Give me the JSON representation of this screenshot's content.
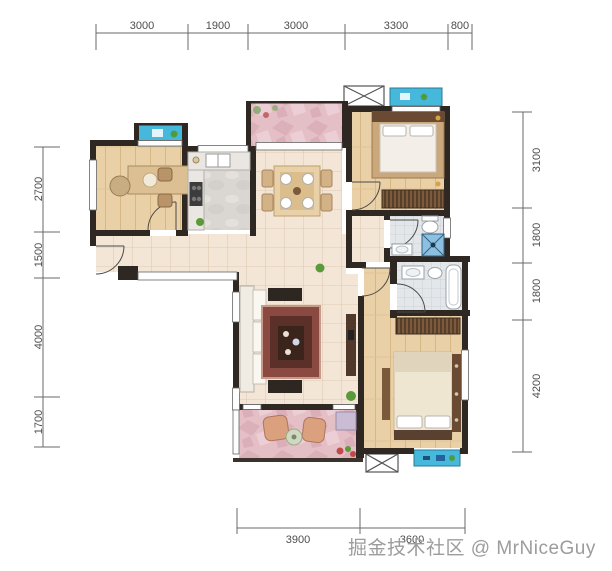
{
  "watermark": {
    "text": "掘金技术社区 @ MrNiceGuy"
  },
  "dimensions": {
    "top": [
      "3000",
      "1900",
      "3000",
      "3300",
      "800"
    ],
    "left": [
      "2700",
      "1500",
      "4000",
      "1700"
    ],
    "right": [
      "3100",
      "1800",
      "1800",
      "4200"
    ],
    "bottom": [
      "3900",
      "3600"
    ]
  },
  "colors": {
    "wall": "#2e2722",
    "tile_floor": "#f3e6d7",
    "wood_floor": "#e9d0a6",
    "terrace_pink": "#e4bfc6",
    "bay_window_cyan": "#45b8dc",
    "bath_tile": "#e4e7ea",
    "kitchen_marble": "#dad6d2",
    "dimension_line": "#6a6a6a",
    "watermark_gray": "#9c9c9c"
  }
}
